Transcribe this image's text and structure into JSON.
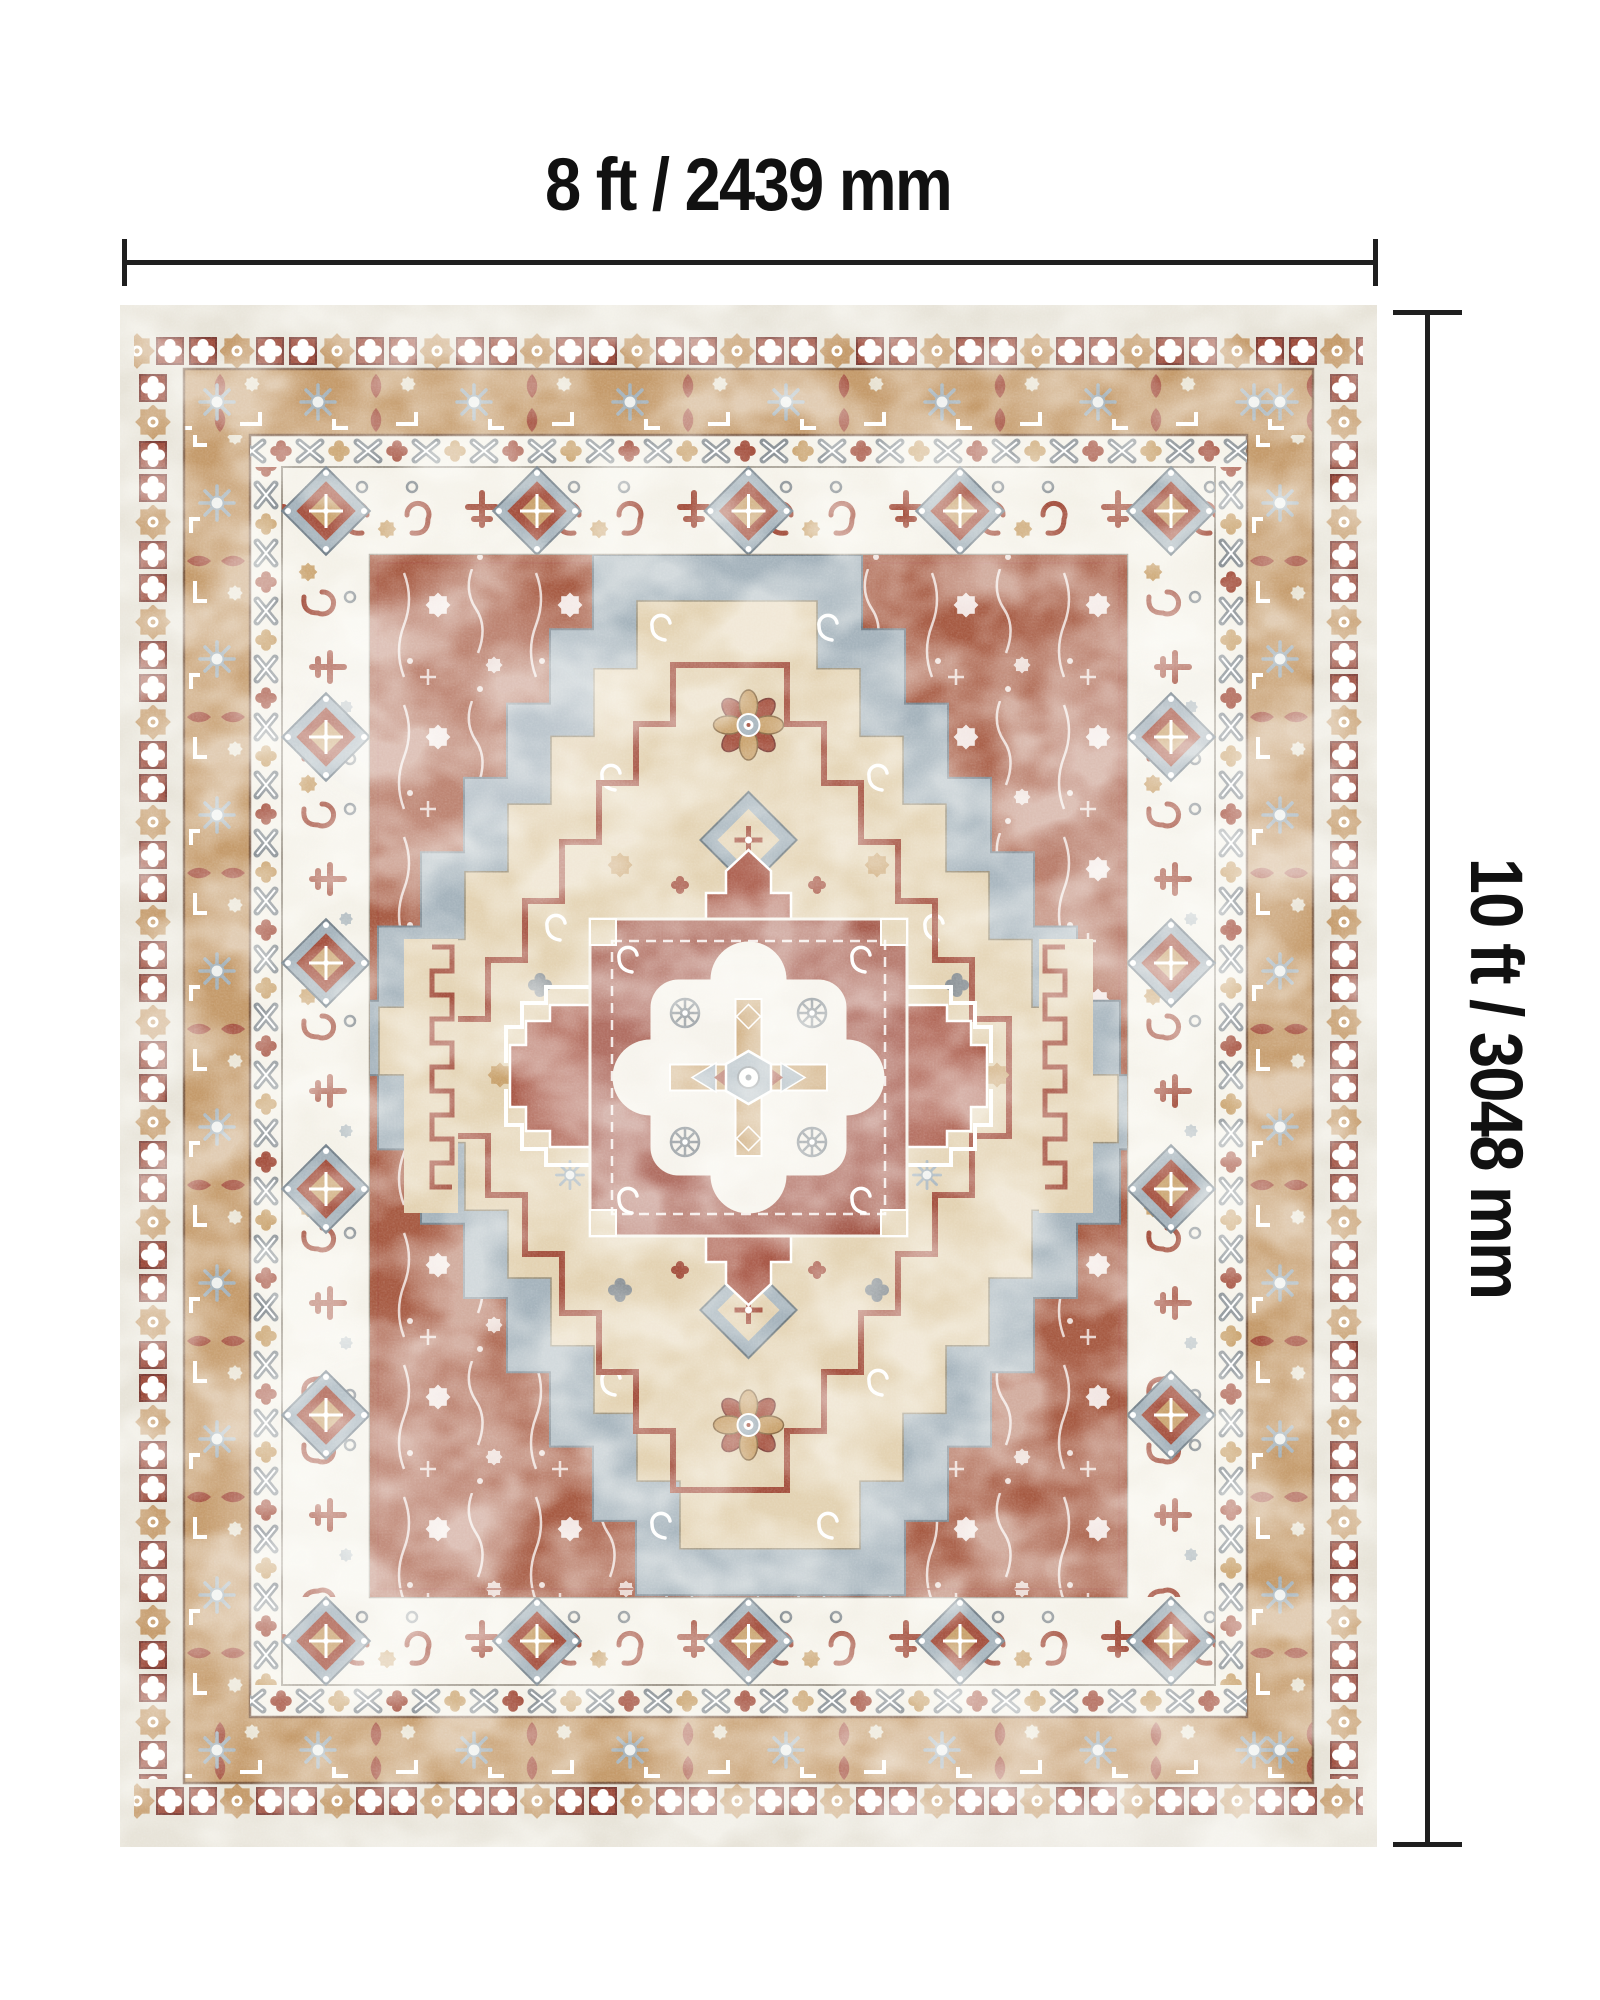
{
  "diagram": {
    "width_label": "8 ft / 2439 mm",
    "height_label": "10 ft / 3048 mm"
  },
  "rug": {
    "style": "Vintage distressed oriental medallion area rug",
    "palette": {
      "cream": "#e7e3d8",
      "ivory": "#f4f1e8",
      "tan": "#c49a6a",
      "gold": "#c9a26d",
      "rust": "#a65a42",
      "maroon": "#9c4a3a",
      "red": "#a4503e",
      "blue_gray": "#a5b3bc",
      "gray": "#8a9196",
      "beige": "#e3d2b2",
      "outline": "#6b4a35",
      "dimension_line": "#1f1f1f"
    }
  }
}
